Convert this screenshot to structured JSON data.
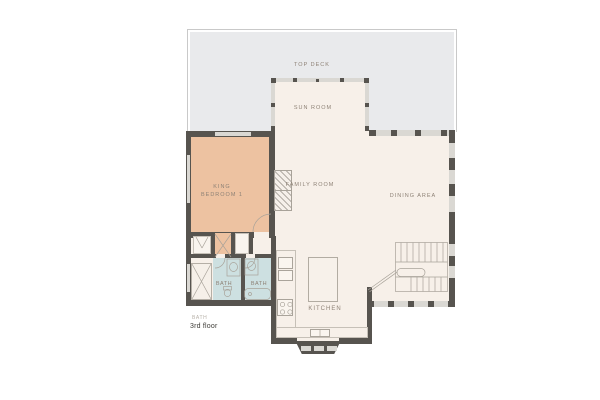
{
  "floorplan": {
    "floor_name": "3rd floor",
    "outside_label": "BATH",
    "rooms": {
      "top_deck": {
        "label": "TOP DECK"
      },
      "sun_room": {
        "label": "SUN ROOM"
      },
      "family_room": {
        "label": "FAMILY ROOM"
      },
      "dining_area": {
        "label": "DINING AREA"
      },
      "king_bedroom": {
        "line1": "KING",
        "line2": "BEDROOM 1"
      },
      "bath_1": {
        "label": "BATH"
      },
      "bath_2": {
        "label": "BATH"
      },
      "kitchen": {
        "label": "KITCHEN"
      }
    },
    "colors": {
      "deck": "#e9eaec",
      "floor": "#f7f0e9",
      "bedroom": "#edc2a1",
      "bath": "#cde0e1",
      "wall": "#57544f",
      "window": "#dad8d3",
      "label": "#8e8276",
      "floor_label": "#3d3b36"
    }
  }
}
